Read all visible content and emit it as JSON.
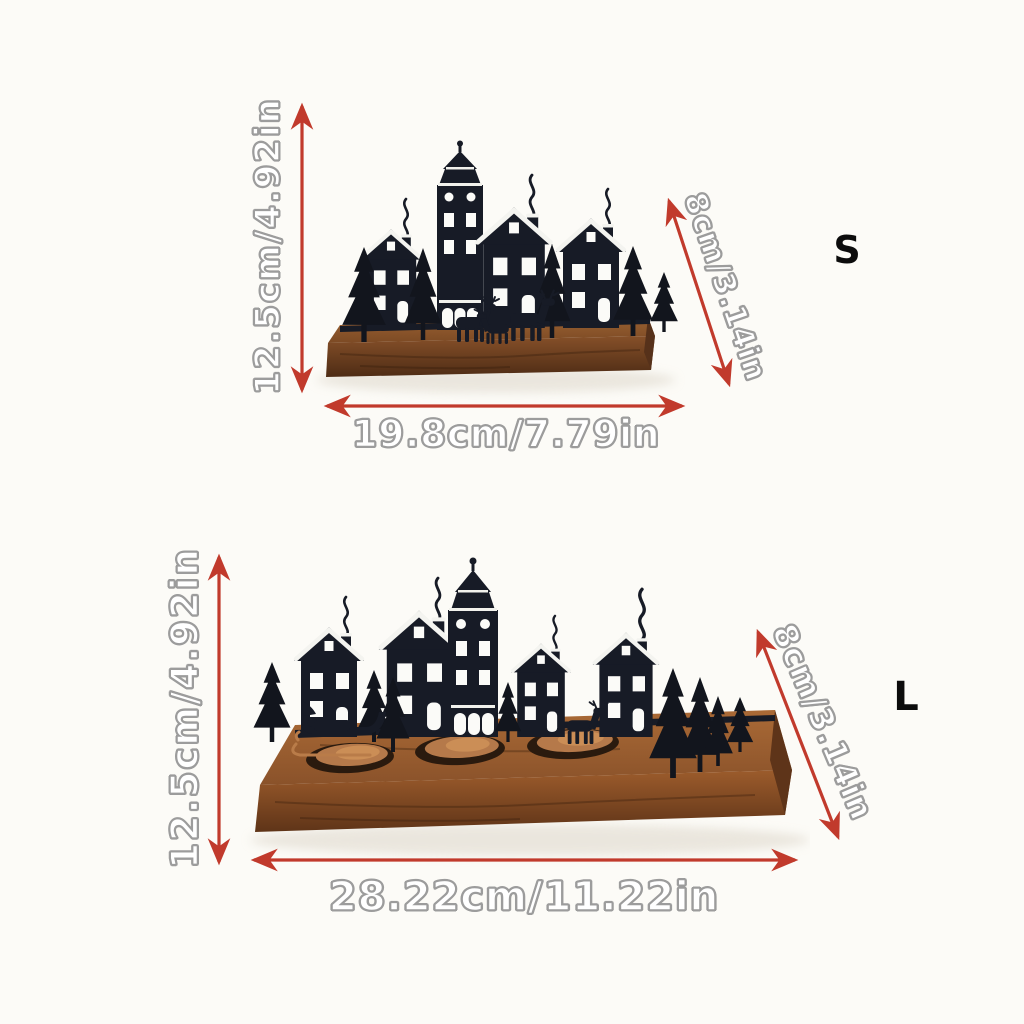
{
  "image_type": "product-size-chart",
  "colors": {
    "background": "#fcfbf7",
    "arrow": "#c13a2c",
    "dim_text_fill": "#ffffff",
    "dim_text_outline": "#9c9c9c",
    "size_label": "#0c0c0c",
    "silhouette": "#171b26",
    "tree": "#12151d",
    "snow": "#f4f4f0",
    "wood_light": "#a06636",
    "wood_dark": "#5a3217",
    "copper": "#b97c49"
  },
  "icons": {
    "dimension_arrow": "double-headed-red-arrow"
  },
  "product": {
    "description": "wooden base christmas village candle holder silhouette"
  },
  "variants": [
    {
      "size_label": "S",
      "height": "12.5cm/4.92in",
      "width": "19.8cm/7.79in",
      "depth": "8cm/3.14in"
    },
    {
      "size_label": "L",
      "height": "12.5cm/4.92in",
      "width": "28.22cm/11.22in",
      "depth": "8cm/3.14in"
    }
  ]
}
